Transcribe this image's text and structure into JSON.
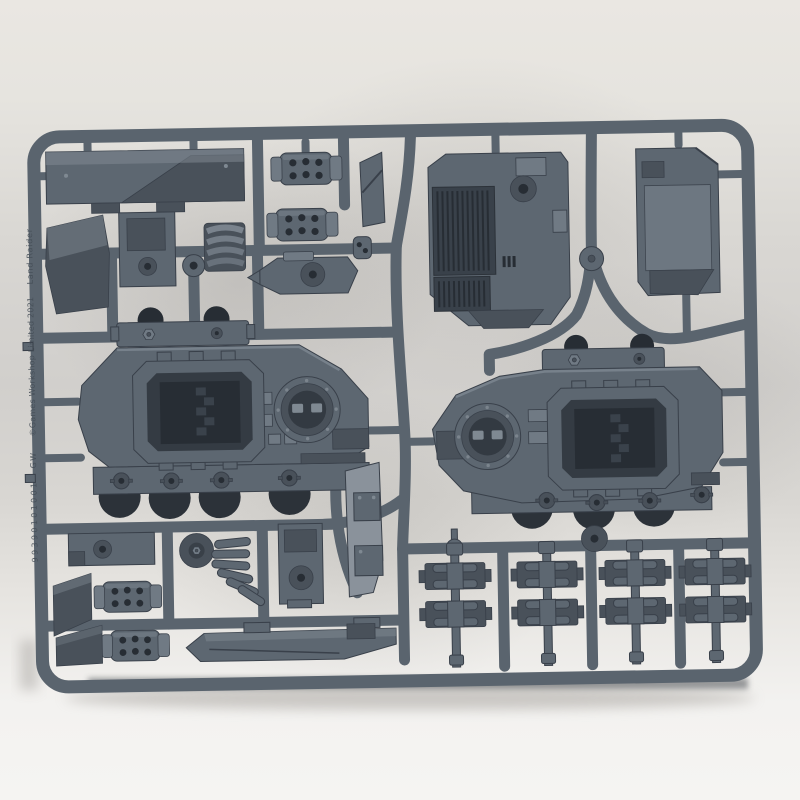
{
  "scene": {
    "type": "photograph",
    "subject": "Grey injection-moulded plastic model sprue with tank hull parts, lying on a pale surface",
    "markings": {
      "product_name": "Land Raider",
      "copyright": "©Games Workshop Limited 2021",
      "maker_initials": "GW",
      "part_code": "99390101001",
      "part_number_example": "18"
    },
    "visible_parts": [
      "long hull roof panel",
      "perforated exhaust drum (x4)",
      "engine deck with radiator grilles",
      "large flat armour panel",
      "left hull side panel with door opening and round hatch",
      "right hull side panel with door opening and round hatch",
      "bolted hinge rail (x2)",
      "track link cluster (x4)",
      "track guard rail",
      "curved tread shield segments (x2)",
      "angled armour wedge blocks",
      "pivot bracket",
      "pulley disc",
      "stepped mounting bracket"
    ],
    "colors": {
      "bg_top": "#eae7e2",
      "bg_bottom": "#f3f2f0",
      "sprue": "#5a646e",
      "part": "#5d6771",
      "part_light": "#707a84",
      "part_dark": "#49515a",
      "highlight": "#7f8992",
      "recess": "#272d34",
      "edge": "#39404a",
      "dome": "#333a42",
      "wheel": "#2c3239",
      "engrave": "#454e57",
      "shadow": "#3e4347",
      "bright_part": "#8a929b"
    }
  }
}
